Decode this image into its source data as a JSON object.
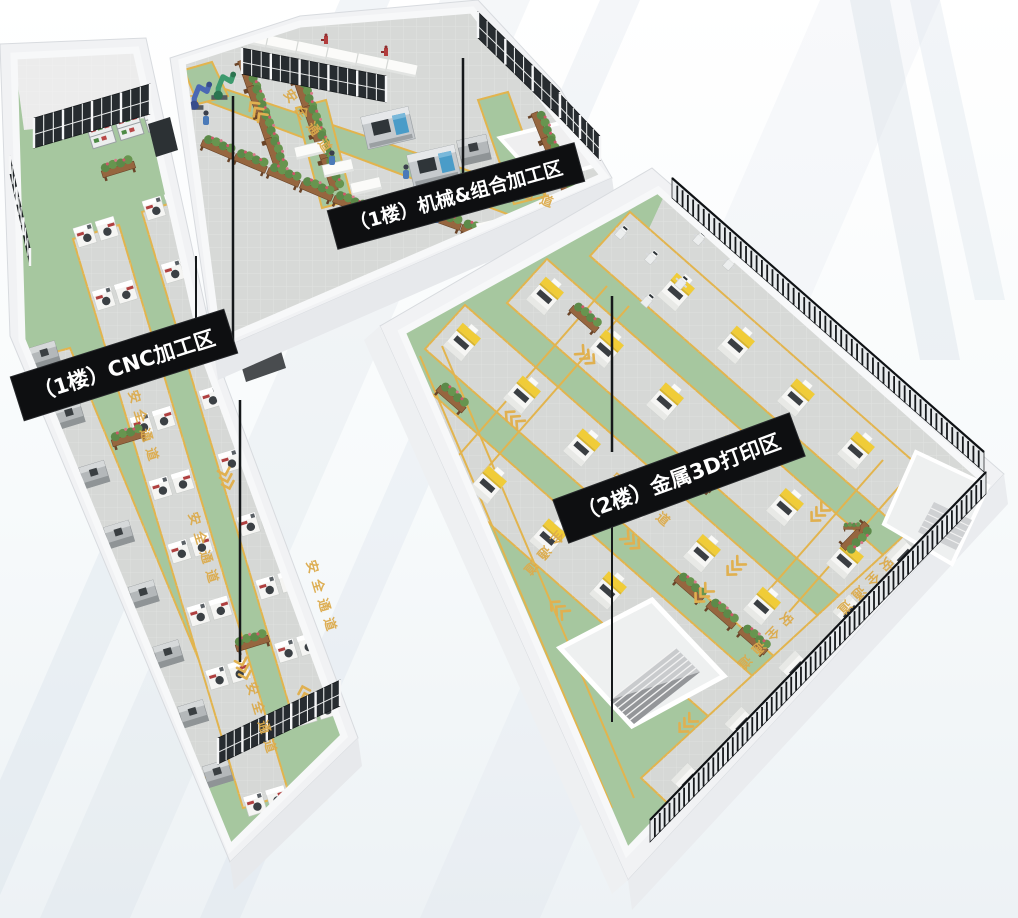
{
  "scene": {
    "type": "isometric-factory-floorplan-render",
    "banners": {
      "cnc_label": "（1楼）CNC加工区",
      "machining_label": "（1楼）机械&组合加工区",
      "printing_label": "（2楼）金属3D打印区"
    },
    "lanes": {
      "safety_label": "安全通道"
    },
    "colors": {
      "floor_green": "#a6c79f",
      "lane_yellow": "#e2b44e",
      "lane_text_yellow": "#dcab4c",
      "floor_gray": "#d7d9d7",
      "wall_white": "#f1f2f4",
      "banner_bg": "#0e0f11",
      "banner_text": "#ffffff",
      "printer_yellow": "#f0cc38",
      "window_dark": "#272c30",
      "planter_wood": "#96663f",
      "robot_blue": "#4a68b4",
      "robot_green": "#3d9a6e"
    },
    "icons": {
      "cnc_machine": "cnc-machine-icon",
      "gray_lathe": "gray-lathe-machine-icon",
      "metal_3d_printer": "metal-3d-printer-icon",
      "planter_box": "planter-box-icon",
      "shelf_rack": "shelf-rack-icon",
      "work_table": "work-table-icon",
      "machining_center": "machining-center-icon",
      "robot_arm_blue": "robot-arm-blue-icon",
      "robot_arm_green": "robot-arm-green-icon",
      "small_robot": "small-robot-icon",
      "worker": "worker-icon",
      "lane_chevrons": "lane-chevrons-icon",
      "mini_red_robot": "mini-red-robot-icon"
    }
  }
}
